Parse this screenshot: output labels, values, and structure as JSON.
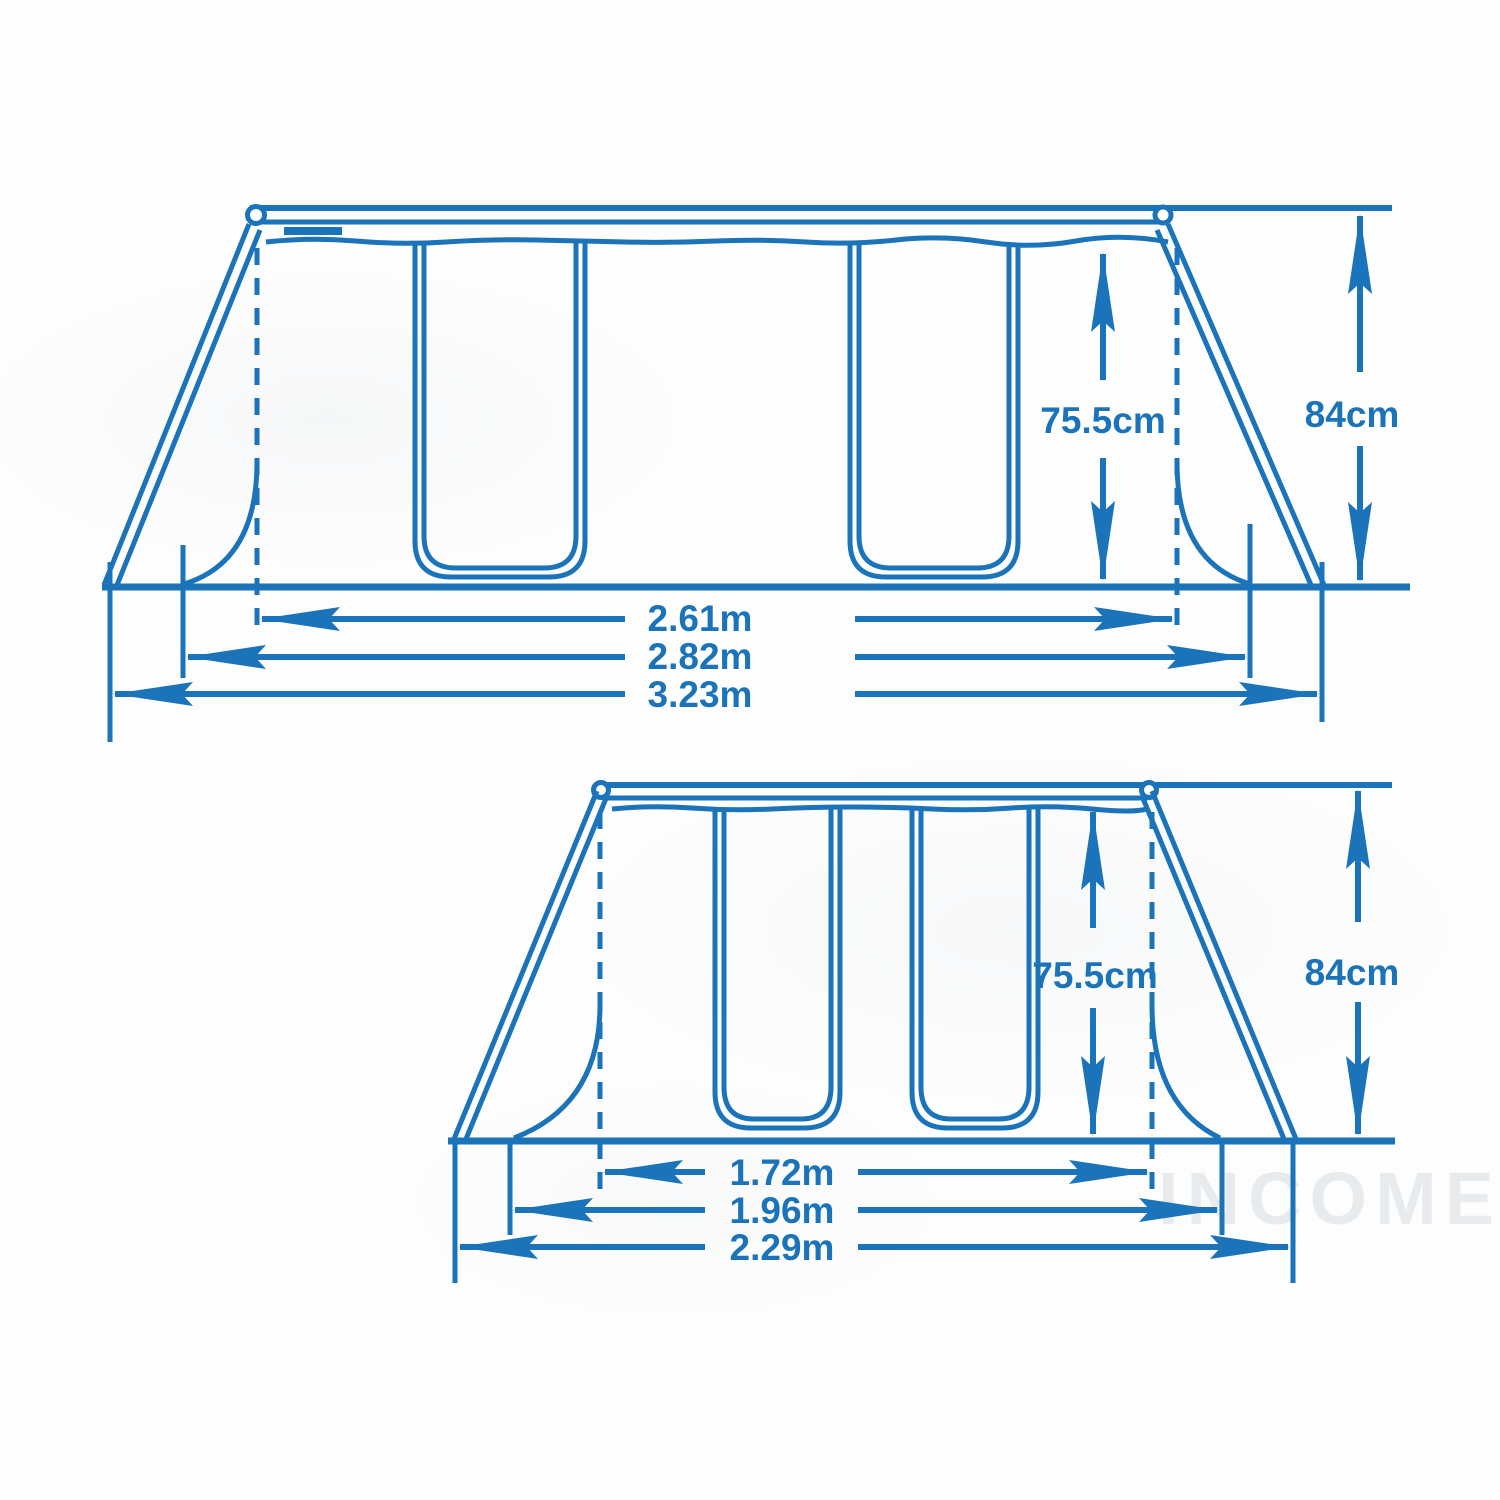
{
  "image_type": "frame pool dimension diagram, two side views",
  "colors": {
    "background": "#fdfdfd",
    "line": "#1b73b9",
    "watermark": "#e8ebee"
  },
  "top_view": {
    "wall_height_label": "75.5cm",
    "frame_height_label": "84cm",
    "inner_width_label": "2.61m",
    "top_width_label": "2.82m",
    "base_width_label": "3.23m"
  },
  "bottom_view": {
    "wall_height_label": "75.5cm",
    "frame_height_label": "84cm",
    "inner_width_label": "1.72m",
    "top_width_label": "1.96m",
    "base_width_label": "2.29m"
  },
  "watermark_text": "INCOME"
}
